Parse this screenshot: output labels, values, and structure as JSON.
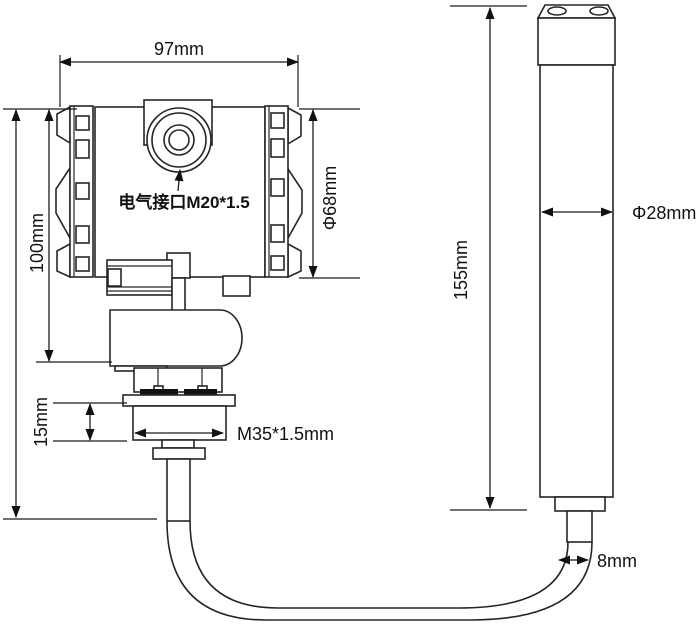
{
  "diagram": {
    "labels": {
      "housing_width": "97mm",
      "housing_height": "100mm",
      "electrical_port": "电气接口M20*1.5",
      "housing_diameter": "Φ68mm",
      "thread_height": "15mm",
      "thread_spec": "M35*1.5mm",
      "probe_height": "155mm",
      "probe_diameter": "Φ28mm",
      "cable_diameter": "8mm"
    },
    "colors": {
      "line": "#262626",
      "text": "#111111",
      "background": "#ffffff"
    }
  }
}
